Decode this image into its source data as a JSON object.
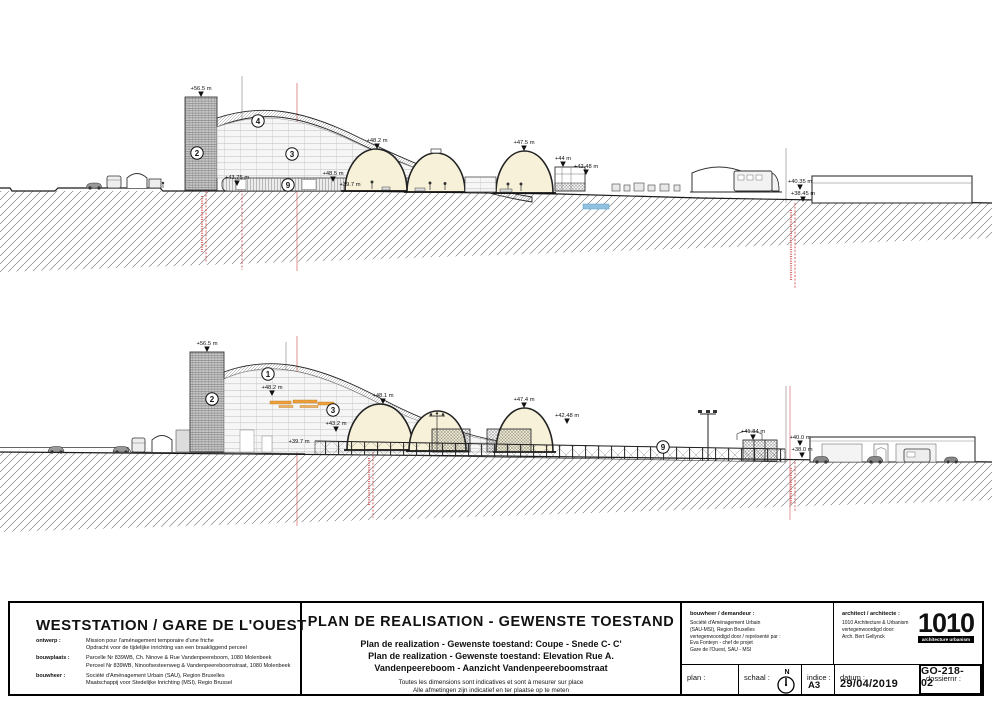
{
  "title_block": {
    "project_title": "WESTSTATION /  GARE DE L'OUEST",
    "info_rows": [
      {
        "label": "ontwerp :",
        "line1": "Mission pour l'aménagement temporaire d'une friche",
        "line2": "Opdracht voor de tijdelijke inrichting van een braakliggend perceel"
      },
      {
        "label": "bouwplaats :",
        "line1": "Parcelle Nr 839WB, Ch. Ninove & Rue Vandenpeereboom, 1080 Molenbeek",
        "line2": "Perceel Nr 839WB, Ninoofsesteenweg & Vandenpeereboomstraat, 1080 Molenbeek"
      },
      {
        "label": "bouwheer :",
        "line1": "Société d'Aménagement Urbain (SAU), Region Bruxelles",
        "line2": "Maatschappij voor Stedelijke Inrichting (MSI), Regio Brussel"
      }
    ],
    "plan_title": "PLAN DE REALISATION - GEWENSTE TOESTAND",
    "plan_subtitle_1": "Plan de realization - Gewenste toestand: Coupe - Snede C- C'",
    "plan_subtitle_2": "Plan de realization - Gewenste toestand: Elevation Rue A.",
    "plan_subtitle_3": "Vandenpeereboom - Aanzicht Vandenpeereboomstraat",
    "disclaimer_1": "Toutes les dimensions sont indicatives et sont à mesurer sur place",
    "disclaimer_2": "Alle afmetingen zijn indicatief en ter plaatse op te meten",
    "client_header": "bouwheer / demandeur :",
    "client_lines": [
      "Société d'Aménagement Urbain",
      "(SAU-MSI), Region Bruxelles",
      "vertegenwoordigd door / représenté par :",
      "Eva Fonteyn - chef de projet",
      "Gare de l'Ouest, SAU - MSI"
    ],
    "architect_header": "architect / architecte :",
    "architect_lines": [
      "1010 Architecture & Urbanism",
      "vertegenwoordigd door:",
      "Arch. Bert Gellynck"
    ],
    "logo_text": "1010",
    "logo_sub": "architecture urbanism",
    "plan_label": "plan :",
    "schaal_label": "schaal :",
    "north_label": "N",
    "indice_label": "indice :",
    "indice_value": "A3",
    "datum_label": "datum :",
    "datum_value": "29/04/2019",
    "dossier_label": "dossiernr :",
    "dossier_value": "GO-218-02"
  },
  "colors": {
    "dome_fill": "#f6f1d8",
    "boundary_pink": "#e8aaaa",
    "dashed_red": "#cc3b3b",
    "metro_blue": "#8fc2e0",
    "awning_orange": "#eda03b"
  },
  "drawings": {
    "top": {
      "name": "Coupe - Snede C-C'",
      "markers": [
        {
          "label": "+56.5 m",
          "x": 201,
          "tip": 97
        },
        {
          "label": "+43.75 m",
          "x": 237,
          "tip": 186
        },
        {
          "label": "+48.5 m",
          "x": 333,
          "tip": 182
        },
        {
          "label": "+39.7 m",
          "x": 350,
          "tip": 193,
          "tri": false
        },
        {
          "label": "+48.2 m",
          "x": 377,
          "tip": 149
        },
        {
          "label": "+47.5 m",
          "x": 524,
          "tip": 151
        },
        {
          "label": "+44 m",
          "x": 563,
          "tip": 167
        },
        {
          "label": "+42.48 m",
          "x": 586,
          "tip": 175
        },
        {
          "label": "+40.35 m",
          "x": 800,
          "tip": 190
        },
        {
          "label": "+38.45 m",
          "x": 803,
          "tip": 202
        }
      ],
      "bubbles": [
        {
          "n": "4",
          "x": 258,
          "y": 121
        },
        {
          "n": "2",
          "x": 197,
          "y": 153
        },
        {
          "n": "3",
          "x": 292,
          "y": 154
        },
        {
          "n": "9",
          "x": 288,
          "y": 185
        }
      ]
    },
    "bottom": {
      "name": "Elevation Rue A. Vandenpeereboom",
      "markers": [
        {
          "label": "+56.5 m",
          "x": 207,
          "tip": 352
        },
        {
          "label": "+48.2 m",
          "x": 272,
          "tip": 396
        },
        {
          "label": "+48.1 m",
          "x": 383,
          "tip": 404
        },
        {
          "label": "+47.4 m",
          "x": 524,
          "tip": 408
        },
        {
          "label": "+43.2 m",
          "x": 336,
          "tip": 432
        },
        {
          "label": "+39.7 m",
          "x": 299,
          "tip": 450,
          "tri": false
        },
        {
          "label": "+42.48 m",
          "x": 567,
          "tip": 424
        },
        {
          "label": "+41.84 m",
          "x": 753,
          "tip": 440
        },
        {
          "label": "+40.0 m",
          "x": 800,
          "tip": 446
        },
        {
          "label": "+38.0 m",
          "x": 802,
          "tip": 458
        }
      ],
      "bubbles": [
        {
          "n": "1",
          "x": 268,
          "y": 374
        },
        {
          "n": "2",
          "x": 212,
          "y": 399
        },
        {
          "n": "3",
          "x": 333,
          "y": 410
        },
        {
          "n": "9",
          "x": 663,
          "y": 447
        }
      ]
    }
  }
}
